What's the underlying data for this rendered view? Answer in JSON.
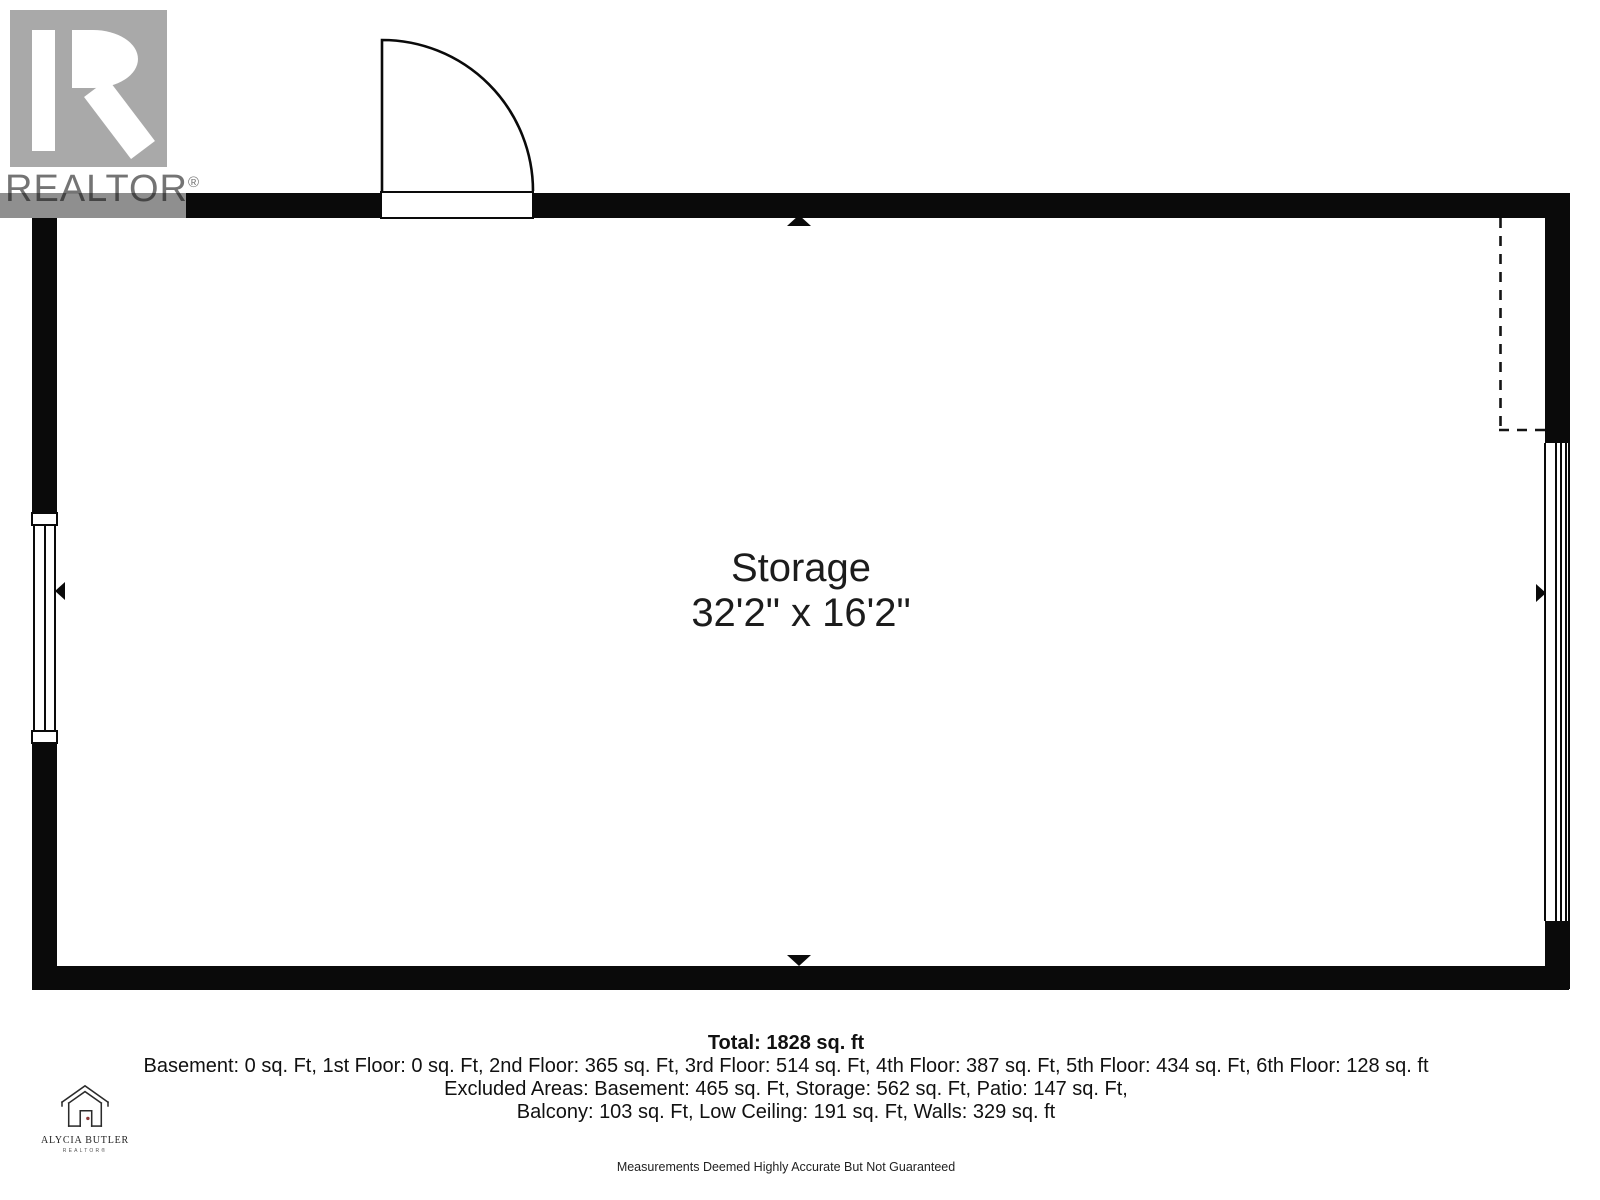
{
  "branding": {
    "wordmark": "REALTOR",
    "registered": "®"
  },
  "room": {
    "name": "Storage",
    "dimensions": "32'2\" x 16'2\""
  },
  "summary": {
    "total": "Total: 1828 sq. ft",
    "floors_line": "Basement: 0 sq. Ft, 1st Floor: 0 sq. Ft, 2nd Floor: 365 sq. Ft, 3rd Floor: 514 sq. Ft, 4th Floor: 387 sq. Ft, 5th Floor: 434 sq. Ft, 6th Floor: 128 sq. ft",
    "excluded_line1": "Excluded Areas: Basement: 465 sq. Ft, Storage: 562 sq. Ft, Patio: 147 sq. Ft,",
    "excluded_line2": "Balcony: 103 sq. Ft, Low Ceiling: 191 sq. Ft, Walls: 329 sq. ft",
    "disclaimer": "Measurements Deemed Highly Accurate But Not Guaranteed"
  },
  "agent": {
    "name": "ALYCIA BUTLER",
    "title": "REALTOR®"
  },
  "colors": {
    "wall": "#0a0a0a",
    "realtor_logo_gray": "#a9a9a9",
    "realtor_band_gray": "#8f8f8f",
    "door_handle_dot": "#8b3a3a",
    "text": "#1c1c1c"
  }
}
